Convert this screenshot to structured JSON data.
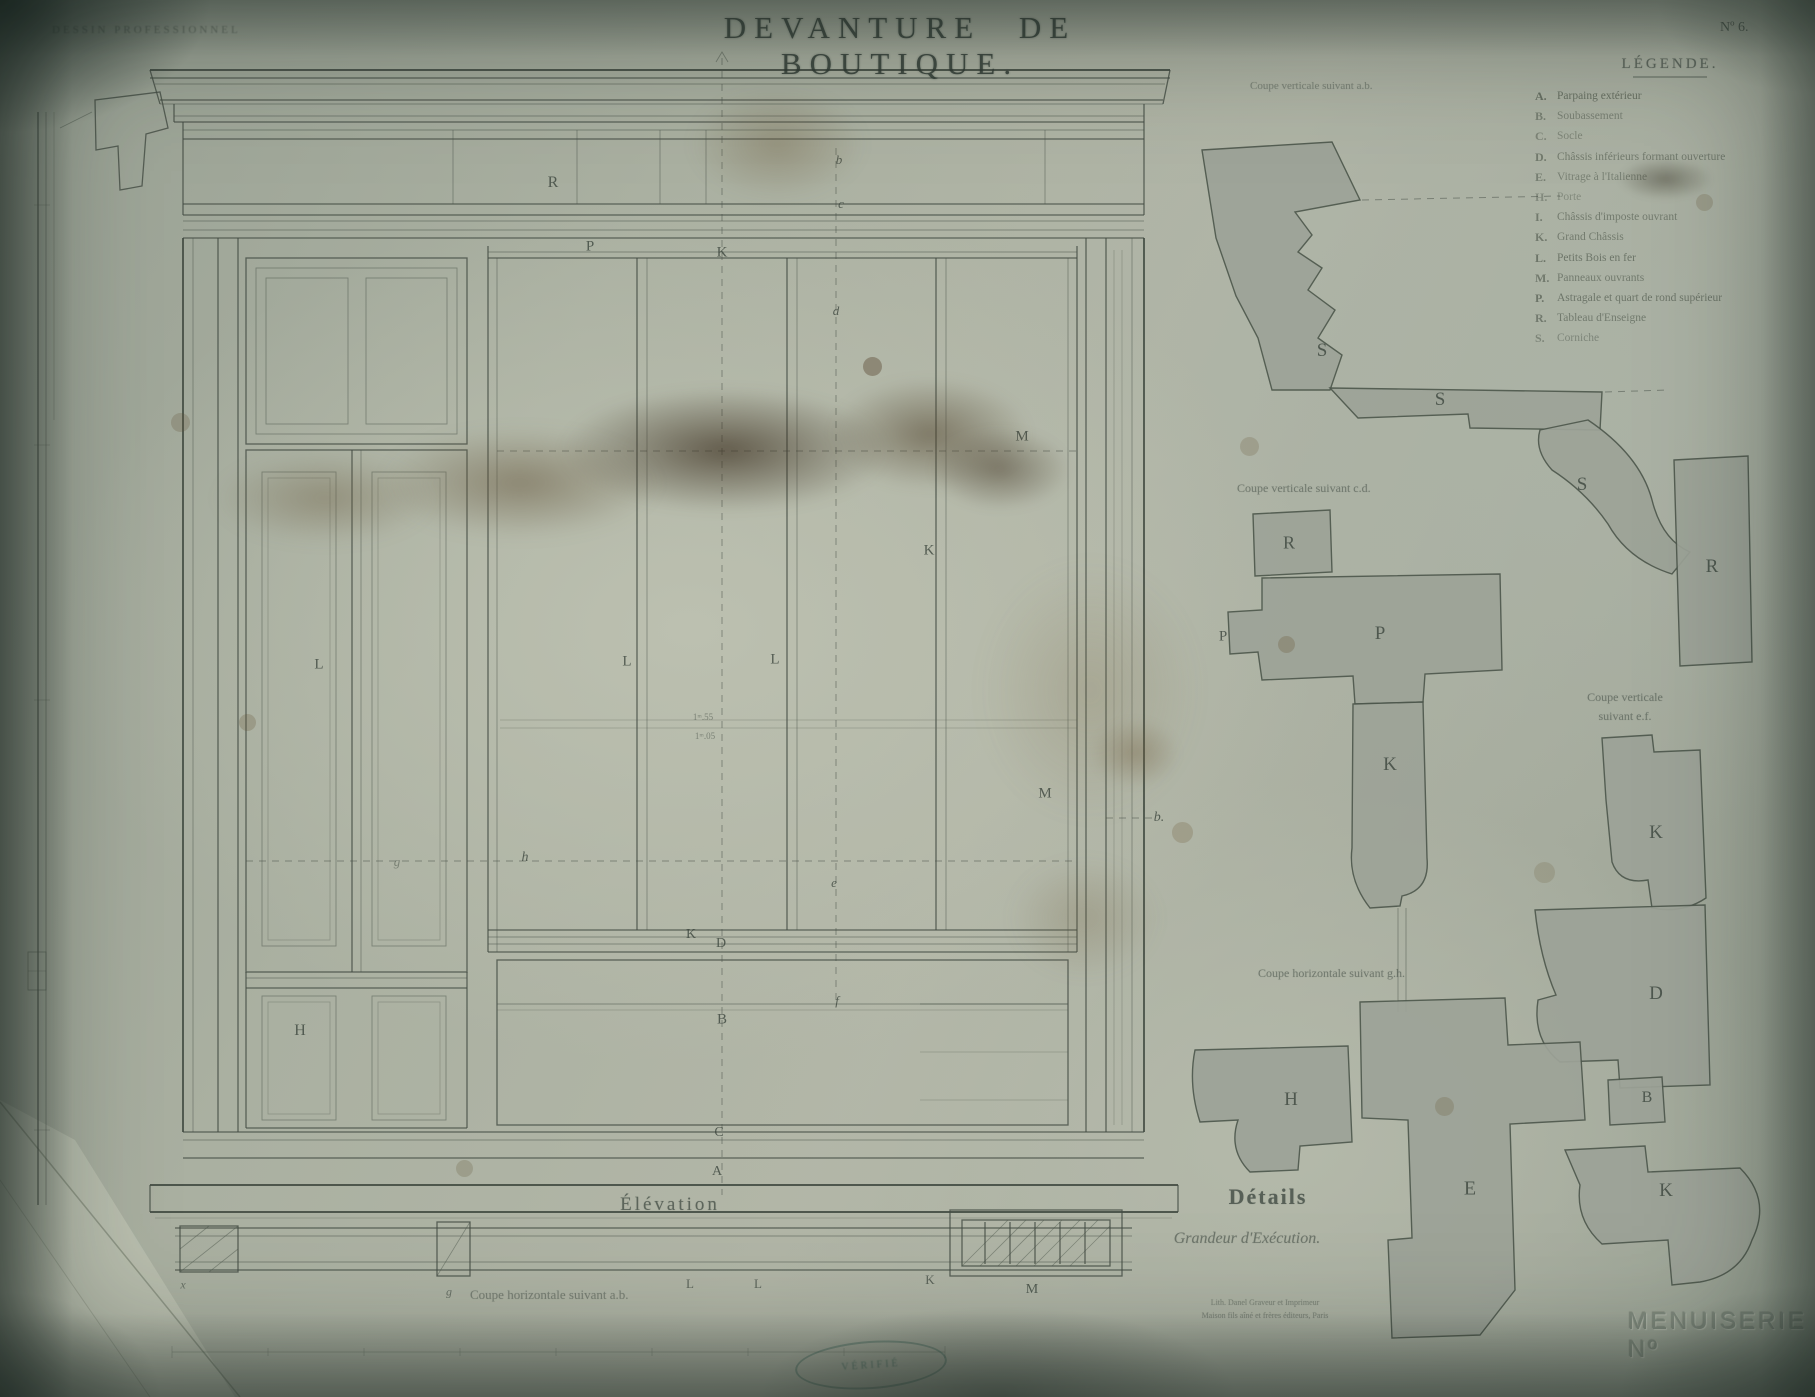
{
  "header": {
    "series": "DESSIN PROFESSIONNEL",
    "title": "DEVANTURE DE BOUTIQUE.",
    "plate_no": "Nº 6."
  },
  "legend": {
    "title": "LÉGENDE.",
    "items": [
      {
        "key": "A.",
        "label": "Parpaing extérieur",
        "o": 0.6
      },
      {
        "key": "B.",
        "label": "Soubassement",
        "o": 0.45
      },
      {
        "key": "C.",
        "label": "Socle",
        "o": 0.4
      },
      {
        "key": "D.",
        "label": "Châssis inférieurs formant ouverture",
        "o": 0.5
      },
      {
        "key": "E.",
        "label": "Vitrage à l'Italienne",
        "o": 0.45
      },
      {
        "key": "H.",
        "label": "Porte",
        "o": 0.35
      },
      {
        "key": "I.",
        "label": "Châssis d'imposte ouvrant",
        "o": 0.5
      },
      {
        "key": "K.",
        "label": "Grand Châssis",
        "o": 0.5
      },
      {
        "key": "L.",
        "label": "Petits Bois en fer",
        "o": 0.55
      },
      {
        "key": "M.",
        "label": "Panneaux ouvrants",
        "o": 0.5
      },
      {
        "key": "P.",
        "label": "Astragale et quart de rond supérieur",
        "o": 0.55
      },
      {
        "key": "R.",
        "label": "Tableau d'Enseigne",
        "o": 0.5
      },
      {
        "key": "S.",
        "label": "Corniche",
        "o": 0.4
      }
    ]
  },
  "captions": {
    "coupe_ab": "Coupe verticale suivant a.b.",
    "coupe_cd": "Coupe verticale suivant c.d.",
    "coupe_ef_1": "Coupe verticale",
    "coupe_ef_2": "suivant e.f.",
    "coupe_gh": "Coupe horizontale suivant g.h.",
    "elevation": "Élévation",
    "details": "Détails",
    "grandeur": "Grandeur d'Exécution.",
    "coupe_ab_bottom": "Coupe horizontale suivant a.b.",
    "imprint_1": "Lith. Danel Graveur et Imprimeur",
    "imprint_2": "Maison fils aîné et frères éditeurs, Paris",
    "stamp": "VÉRIFIÉ",
    "menuiserie": "MENUISERIE Nº"
  },
  "drawing": {
    "labels": [
      {
        "t": "R",
        "x": 553,
        "y": 183,
        "s": 16
      },
      {
        "t": "b",
        "x": 839,
        "y": 160,
        "s": 13,
        "i": 1
      },
      {
        "t": "c",
        "x": 841,
        "y": 204,
        "s": 13,
        "i": 1
      },
      {
        "t": "P",
        "x": 590,
        "y": 247,
        "s": 15
      },
      {
        "t": "K",
        "x": 722,
        "y": 253,
        "s": 15
      },
      {
        "t": "d",
        "x": 836,
        "y": 311,
        "s": 13,
        "i": 1
      },
      {
        "t": "M",
        "x": 1022,
        "y": 437,
        "s": 15
      },
      {
        "t": "K",
        "x": 929,
        "y": 551,
        "s": 15
      },
      {
        "t": "L",
        "x": 319,
        "y": 665,
        "s": 15
      },
      {
        "t": "L",
        "x": 627,
        "y": 662,
        "s": 15
      },
      {
        "t": "L",
        "x": 775,
        "y": 660,
        "s": 15
      },
      {
        "t": "M",
        "x": 1045,
        "y": 794,
        "s": 15
      },
      {
        "t": "b.",
        "x": 1159,
        "y": 818,
        "s": 14,
        "i": 1
      },
      {
        "t": "g",
        "x": 397,
        "y": 862,
        "s": 13,
        "i": 1,
        "o": 0.45
      },
      {
        "t": "h",
        "x": 525,
        "y": 858,
        "s": 14,
        "i": 1
      },
      {
        "t": "e",
        "x": 834,
        "y": 883,
        "s": 13,
        "i": 1
      },
      {
        "t": "K",
        "x": 691,
        "y": 935,
        "s": 14
      },
      {
        "t": "D",
        "x": 721,
        "y": 944,
        "s": 14
      },
      {
        "t": "f",
        "x": 837,
        "y": 1001,
        "s": 13,
        "i": 1
      },
      {
        "t": "B",
        "x": 722,
        "y": 1020,
        "s": 15
      },
      {
        "t": "H",
        "x": 300,
        "y": 1031,
        "s": 16
      },
      {
        "t": "C",
        "x": 719,
        "y": 1133,
        "s": 14
      },
      {
        "t": "A",
        "x": 717,
        "y": 1172,
        "s": 14
      },
      {
        "t": "1ᵐ.55",
        "x": 703,
        "y": 717,
        "s": 9,
        "o": 0.5
      },
      {
        "t": "1ᵐ.05",
        "x": 705,
        "y": 736,
        "s": 9,
        "o": 0.5
      },
      {
        "t": "x",
        "x": 183,
        "y": 1285,
        "s": 12,
        "i": 1,
        "o": 0.6
      },
      {
        "t": "g",
        "x": 449,
        "y": 1292,
        "s": 12,
        "i": 1,
        "o": 0.6
      },
      {
        "t": "L",
        "x": 690,
        "y": 1284,
        "s": 13,
        "o": 0.7
      },
      {
        "t": "L",
        "x": 758,
        "y": 1284,
        "s": 13,
        "o": 0.7
      },
      {
        "t": "K",
        "x": 930,
        "y": 1280,
        "s": 13,
        "o": 0.7
      },
      {
        "t": "M",
        "x": 1032,
        "y": 1290,
        "s": 14
      },
      {
        "t": "S",
        "x": 1322,
        "y": 351,
        "s": 19
      },
      {
        "t": "S",
        "x": 1440,
        "y": 400,
        "s": 19
      },
      {
        "t": "S",
        "x": 1582,
        "y": 485,
        "s": 19
      },
      {
        "t": "R",
        "x": 1712,
        "y": 567,
        "s": 19
      },
      {
        "t": "R",
        "x": 1289,
        "y": 543,
        "s": 18
      },
      {
        "t": "P",
        "x": 1223,
        "y": 637,
        "s": 15
      },
      {
        "t": "P",
        "x": 1380,
        "y": 634,
        "s": 19
      },
      {
        "t": "K",
        "x": 1390,
        "y": 765,
        "s": 19
      },
      {
        "t": "K",
        "x": 1656,
        "y": 833,
        "s": 19
      },
      {
        "t": "D",
        "x": 1656,
        "y": 994,
        "s": 19
      },
      {
        "t": "B",
        "x": 1647,
        "y": 1098,
        "s": 16
      },
      {
        "t": "K",
        "x": 1666,
        "y": 1191,
        "s": 19
      },
      {
        "t": "H",
        "x": 1291,
        "y": 1100,
        "s": 19
      },
      {
        "t": "E",
        "x": 1470,
        "y": 1189,
        "s": 20
      }
    ]
  },
  "colors": {
    "paper": "#aab0a2",
    "ink": "#3c463f",
    "shape_fill": "#9da398",
    "shape_stroke": "#4e584d",
    "stain": "#6d5c42",
    "stamp": "#2c5c50"
  }
}
